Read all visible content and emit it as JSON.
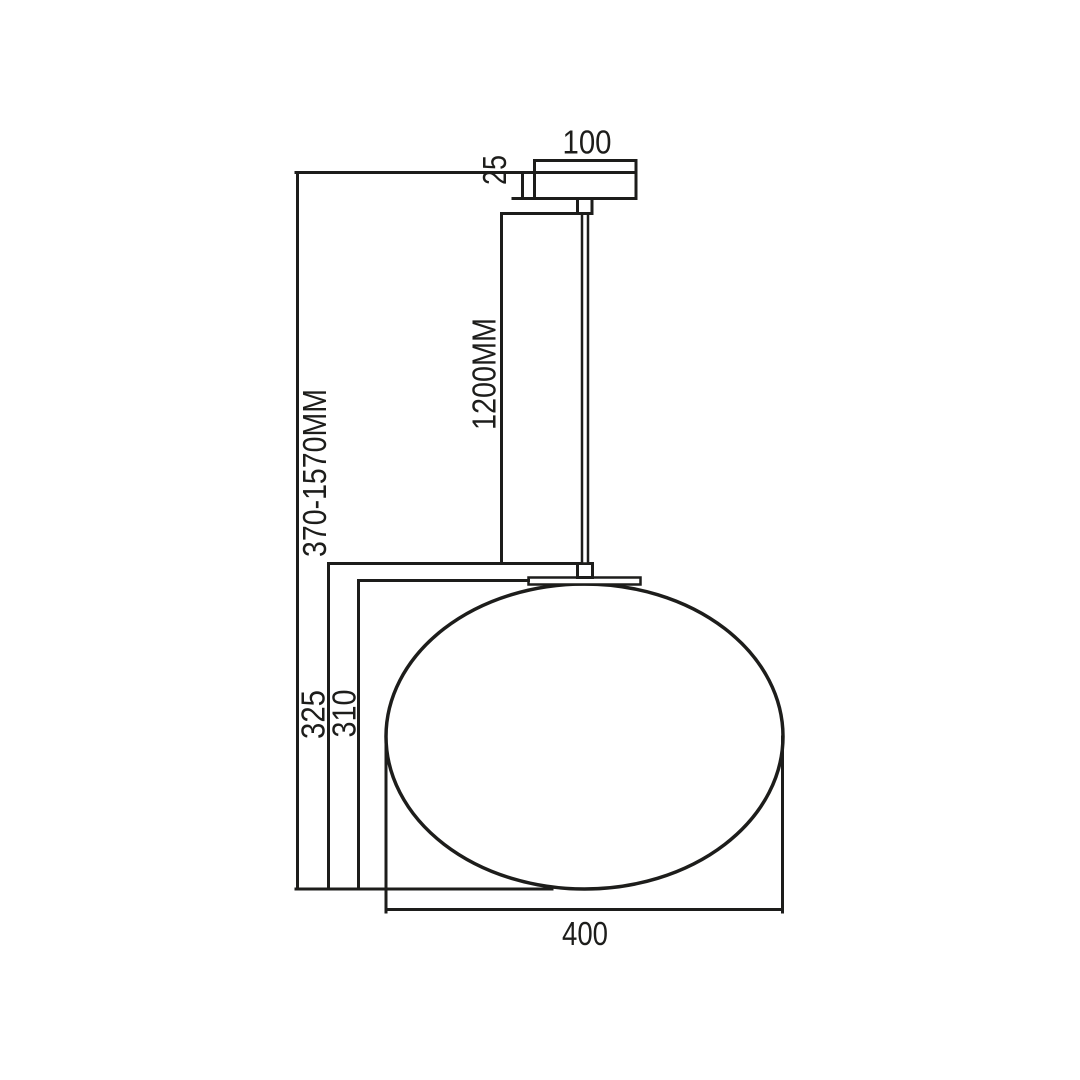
{
  "page": {
    "background": "#ffffff"
  },
  "drawing": {
    "type": "pendant-lamp-dimension-drawing",
    "line_color": "#1d1d1b",
    "labels": {
      "canopy_width": "100",
      "canopy_height": "25",
      "rod_length": "1200MM",
      "overall_height": "370-1570MM",
      "hanging_height": "325",
      "shade_height": "310",
      "shade_width": "400"
    }
  }
}
